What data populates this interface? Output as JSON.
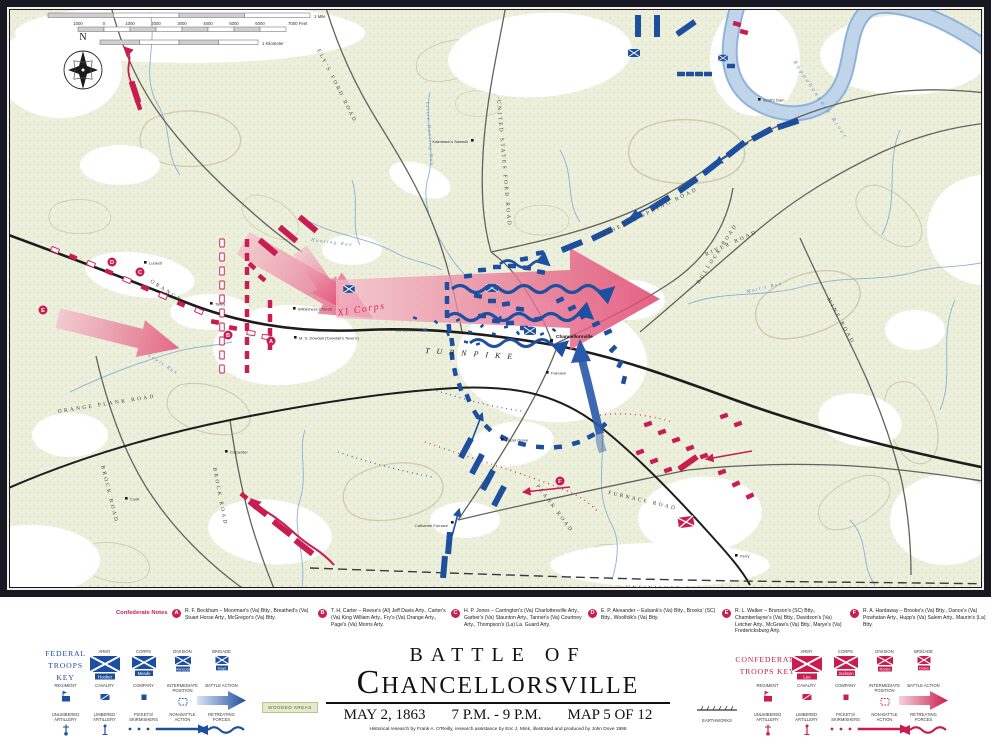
{
  "map": {
    "compass_n": "N",
    "scale": {
      "mile": "1 Mile",
      "feet": [
        "1000",
        "0",
        "1000",
        "2000",
        "3000",
        "4000",
        "5000",
        "6000",
        "7000 Feet"
      ],
      "km": "1 Kilometer"
    },
    "roads": {
      "orange": "Orange",
      "turnpike": "Turnpike",
      "orange_plank": "Orange Plank Road",
      "brock_w": "Brock Road",
      "brock_e": "Brock Road",
      "elys_ford": "Ely's Ford Road",
      "us_ford": "United States Ford Road",
      "mineral_spring": "Mineral Spring Road",
      "bullock": "Bullock Road",
      "river": "River Road",
      "mine": "Mine Road",
      "furnace": "Furnace Road",
      "plank": "Plank Road",
      "railroad": "Unfinished Railroad"
    },
    "streams": {
      "rappahannock": "Rappahannock River",
      "little_hunting": "Little Hunting Run",
      "hunting": "Hunting Run",
      "motts": "Mott's Run",
      "lewis": "Lewis Run"
    },
    "places": {
      "luckett": "Luckett",
      "talley": "Talley",
      "wilderness_church": "Wilderness Church",
      "dowdall": "M. S. Dowdall ('Dowdall's Tavern')",
      "old_schoolhouse": "Old Schoolhouse",
      "chancellorsville": "Chancellorsville",
      "fairview": "Fairview",
      "hazel_grove": "Hazel Grove",
      "catharine_furnace": "Catharine Furnace",
      "kalmbach": "Kalmbach's Sawmill",
      "scotts_dam": "Scott's Dam",
      "cook": "Cook",
      "carpenter": "Carpenter",
      "perry": "Perry"
    },
    "xi_corps": "XI Corps",
    "note_markers": {
      "a": "A",
      "b": "B",
      "c": "C",
      "d": "D",
      "e": "E",
      "f": "F"
    }
  },
  "notes": {
    "heading": "Confederate Notes",
    "items": [
      {
        "letter": "A",
        "text": "R. F. Beckham – Moorman's (Va) Btty., Breathed's (Va) Stuart Horse Arty., McGregor's (Va) Btty."
      },
      {
        "letter": "B",
        "text": "T. H. Carter – Reese's (Al) Jeff Davis Arty., Carter's (Va) King William Arty., Fry's (Va) Orange Arty., Page's (Va) Morris Arty."
      },
      {
        "letter": "C",
        "text": "H. P. Jones – Carrington's (Va) Charlottesville Arty., Garber's (Va) Staunton Arty., Tanner's (Va) Courtney Arty., Thompson's (La) La. Guard Arty."
      },
      {
        "letter": "D",
        "text": "E. P. Alexander – Eubank's (Va) Btty., Brooks' (SC) Btty., Woolfolk's (Va) Btty."
      },
      {
        "letter": "E",
        "text": "R. L. Walker – Brunson's (SC) Btty., Chamberlayne's (Va) Btty., Davidson's (Va) Letcher Arty., McGraw's (Va) Btty., Marye's (Va) Fredericksburg Arty."
      },
      {
        "letter": "F",
        "text": "R. A. Hardaway – Brooke's (Va) Btty., Dance's (Va) Powhatan Arty., Hupp's (Va) Salem Arty., Maurin's (La) Btty."
      }
    ]
  },
  "legend": {
    "federal": {
      "title": "Federal Troops Key",
      "labels": {
        "army": "Army",
        "corps": "Corps",
        "division": "Division",
        "brigade": "Brigade",
        "regiment": "Regiment",
        "cavalry": "Cavalry",
        "company": "Company",
        "intermediate": "Intermediate Position",
        "battle": "Battle Action",
        "unlimbered": "Unlimbered Artillery",
        "limbered": "Limbered Artillery",
        "pickets": "Pickets/ Skirmishers",
        "nonbattle": "Non-Battle Action",
        "retreating": "Retreating Forces"
      },
      "names": {
        "army": "Hooker",
        "corps": "Meade",
        "division": "Hancock",
        "brigade": "Hays"
      }
    },
    "confederate": {
      "title": "Confederate Troops Key",
      "labels": {
        "army": "Army",
        "corps": "Corps",
        "division": "Division",
        "brigade": "Brigade",
        "regiment": "Regiment",
        "cavalry": "Cavalry",
        "company": "Company",
        "intermediate": "Intermediate Position",
        "battle": "Battle Action",
        "unlimbered": "Unlimbered Artillery",
        "limbered": "Limbered Artillery",
        "pickets": "Pickets/ Skirmishers",
        "nonbattle": "Non-Battle Action",
        "retreating": "Retreating Forces"
      },
      "names": {
        "army": "Lee",
        "corps": "Jackson",
        "division": "Rodes",
        "brigade": "Doles"
      }
    },
    "wooded": "Wooded Areas",
    "earthworks": "Earthworks"
  },
  "title": {
    "line1": "Battle of",
    "line2": "Chancellorsville",
    "date": "May 2, 1863",
    "time": "7 p.m. - 9 p.m.",
    "map_no": "Map 5 of 12",
    "credit": "Historical research by Frank A. O'Reilly, research assistance by Eric J. Mink, illustrated and produced by John Dove   1998"
  },
  "colors": {
    "federal_blue": "#1d4f9e",
    "confederate_red": "#c81d4e",
    "wooded_green": "#e3ebc8"
  }
}
